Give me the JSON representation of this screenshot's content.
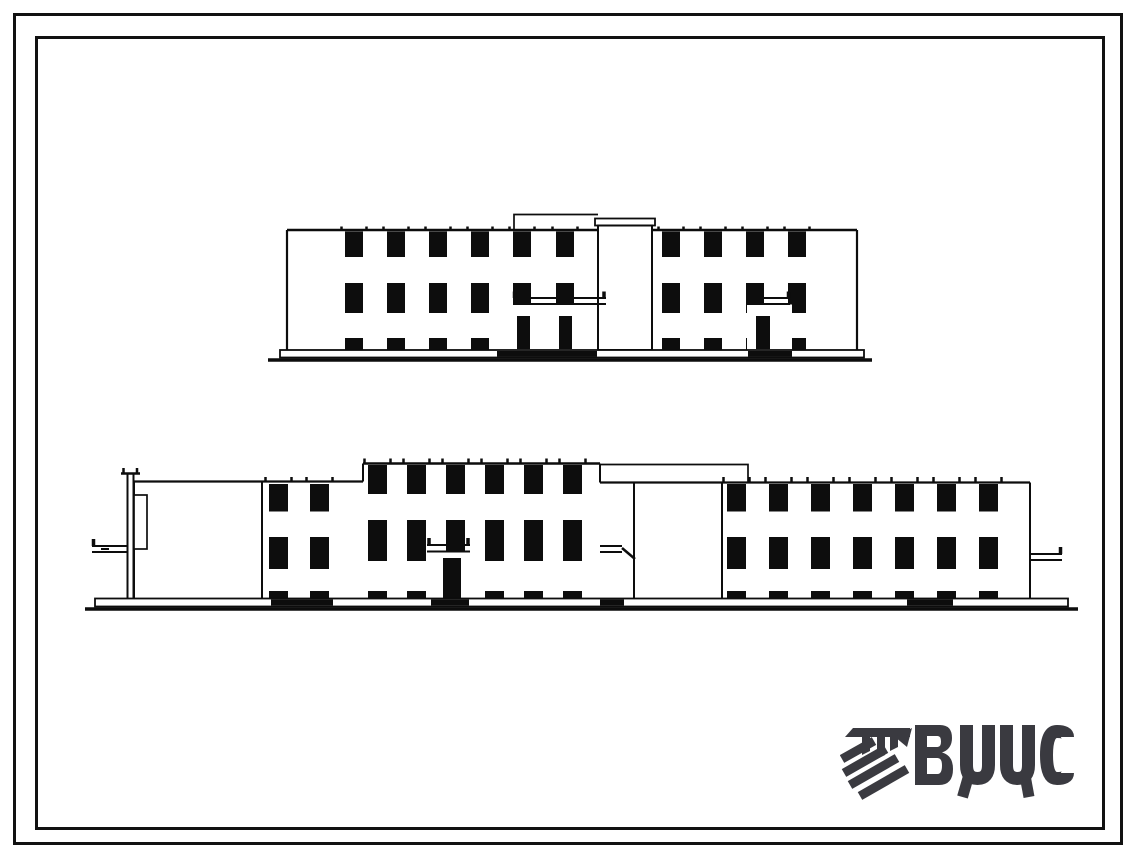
{
  "sheet": {
    "background": "#ffffff",
    "frame_color": "#111111",
    "drawing_ink": "#0d0d0d"
  },
  "logo": {
    "text": "ВЦИС",
    "color": "#3a3a40",
    "emblem": "vcis-hatched-emblem-icon"
  }
}
